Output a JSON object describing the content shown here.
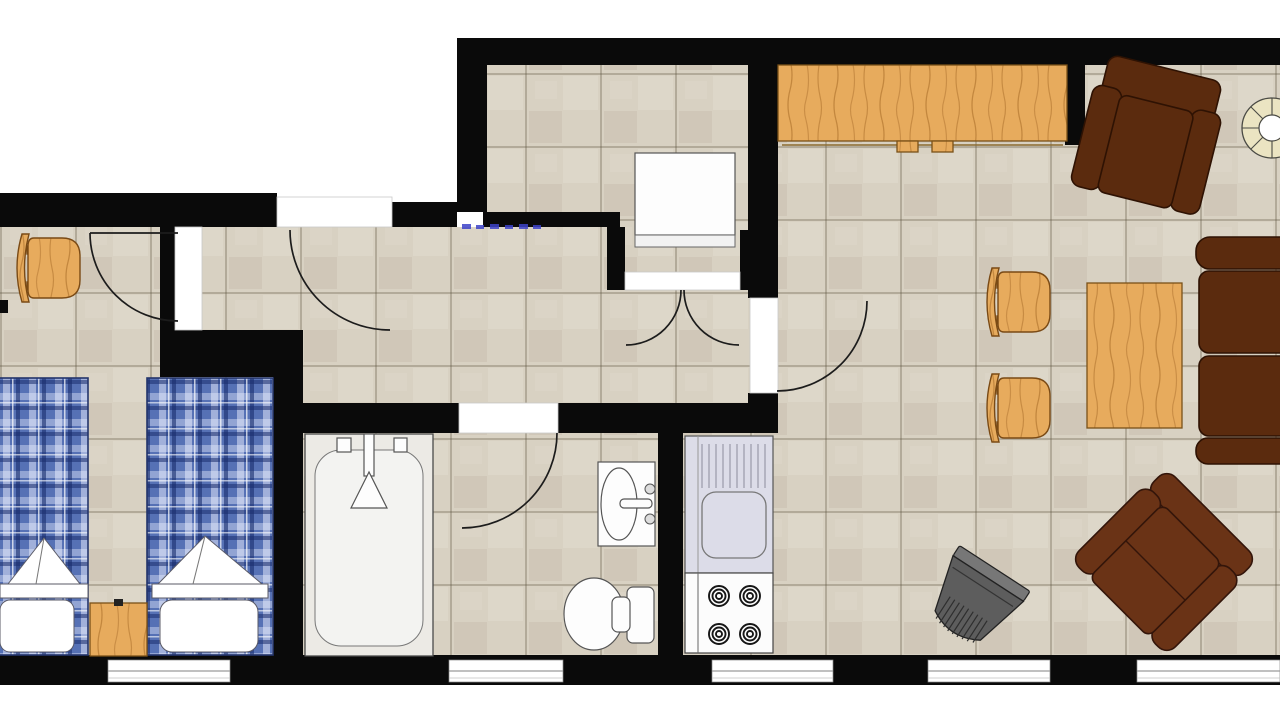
{
  "meta": {
    "kind": "apartment floor plan, top-down view",
    "rooms": [
      "bedroom",
      "hallway",
      "kitchen-room",
      "bathroom",
      "kitchenette-nook",
      "living-room"
    ],
    "window_count": 5,
    "door_count": 6,
    "furniture": [
      "desk-chair",
      "twin-bed-left",
      "twin-bed-right",
      "nightstand",
      "bathtub",
      "wash-basin",
      "toilet",
      "kitchen-sink-counter",
      "stove",
      "refrigerator",
      "kitchen-counter",
      "armchair",
      "wicker-round-chair",
      "dining-chair-1",
      "dining-chair-2",
      "dining-table",
      "sofa-right",
      "sofa-diagonal",
      "tv-set"
    ]
  },
  "colors": {
    "outside": "#ffffff",
    "wall": "#0a0a0a",
    "floor": "#d8d1c2",
    "floor_grout": "rgba(90,78,60,0.30)",
    "wood": "#e7ab5d",
    "chair_wood": "#eab268",
    "bed_plaid": "#5671b5",
    "sofa": "#5b2b0e",
    "sofa2": "#6a3316",
    "counter_unit": "#dcdce8",
    "tv": "#5d5d5d",
    "wicker": "#ebe4c2",
    "blue_marks": "#3d43c8",
    "fixture": "#fdfdfd"
  }
}
